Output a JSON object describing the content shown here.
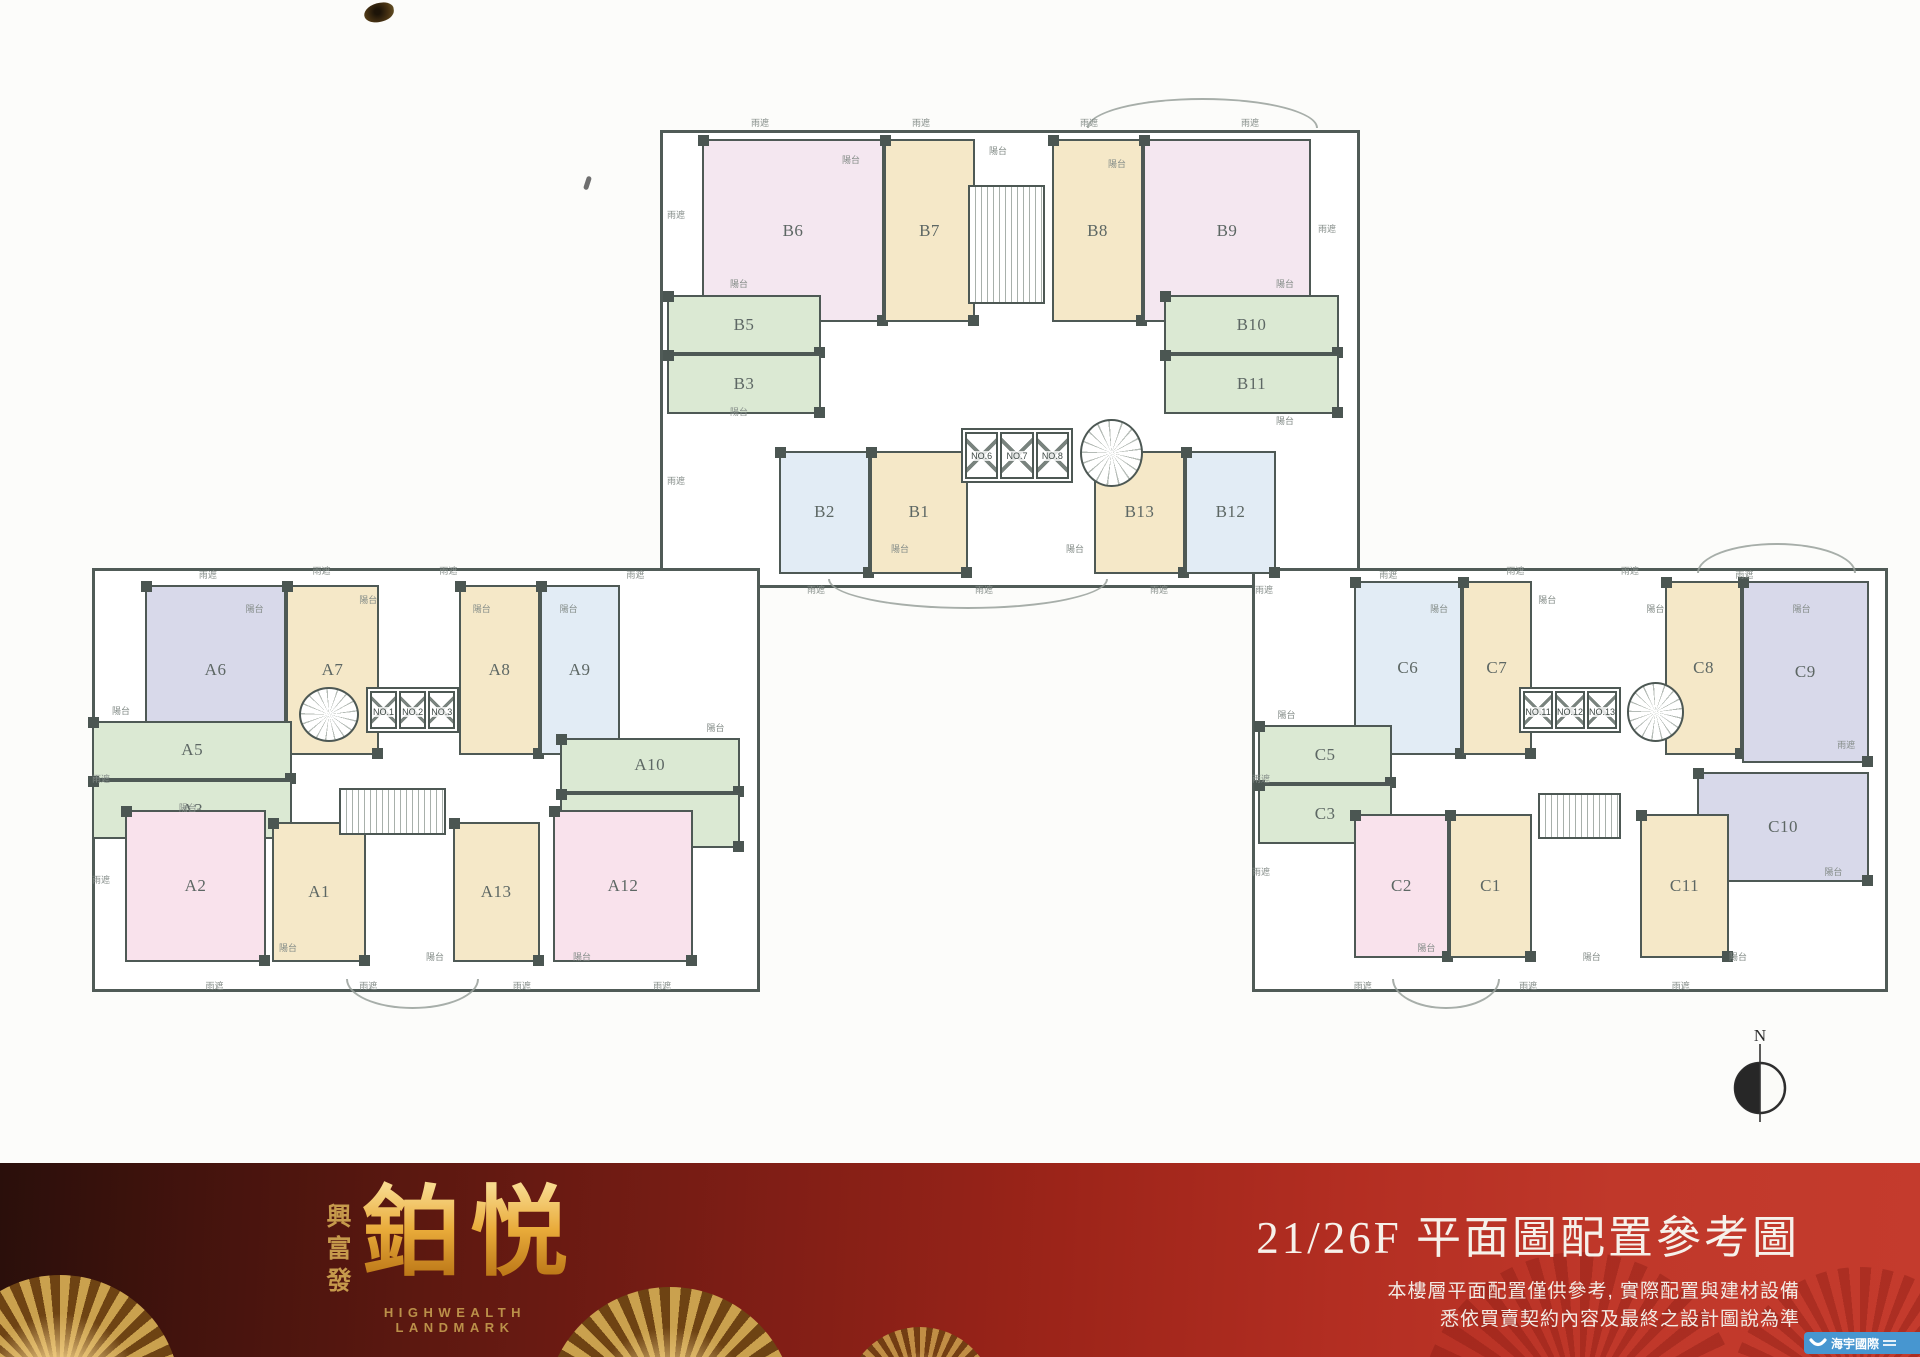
{
  "compass": {
    "label": "N"
  },
  "palette": {
    "green": "#dbe9d3",
    "tan": "#f5e8c8",
    "pink": "#f9e2ec",
    "palepink": "#f4e7f0",
    "blue": "#e2ecf5",
    "lavender": "#d8d9ea"
  },
  "buildings": [
    {
      "id": "building-b",
      "frame": [
        660,
        130,
        700,
        458
      ],
      "units": [
        [
          "B6",
          "palepink",
          6,
          2,
          26,
          40
        ],
        [
          "B7",
          "tan",
          32,
          2,
          13,
          40
        ],
        [
          "B8",
          "tan",
          56,
          2,
          13,
          40
        ],
        [
          "B9",
          "palepink",
          69,
          2,
          24,
          40
        ],
        [
          "B5",
          "green",
          1,
          36,
          22,
          13
        ],
        [
          "B3",
          "green",
          1,
          49,
          22,
          13
        ],
        [
          "B10",
          "green",
          72,
          36,
          25,
          13
        ],
        [
          "B11",
          "green",
          72,
          49,
          25,
          13
        ],
        [
          "B2",
          "blue",
          17,
          70,
          13,
          27
        ],
        [
          "B1",
          "tan",
          30,
          70,
          14,
          27
        ],
        [
          "B13",
          "tan",
          62,
          70,
          13,
          27
        ],
        [
          "B12",
          "blue",
          75,
          70,
          13,
          27
        ]
      ],
      "lifts": {
        "labels": [
          "NO.6",
          "NO.7",
          "NO.8"
        ],
        "box": [
          43,
          65,
          16,
          12
        ]
      },
      "stairRect": [
        44,
        12,
        11,
        26
      ],
      "stairRound": [
        60,
        63,
        9,
        15
      ],
      "arcs": [
        [
          61,
          -7,
          33,
          "top"
        ],
        [
          24,
          98,
          40,
          "bottom"
        ]
      ],
      "annotations": [
        [
          "雨遮",
          13,
          -3
        ],
        [
          "雨遮",
          36,
          -3
        ],
        [
          "陽台",
          26,
          5
        ],
        [
          "陽台",
          47,
          3
        ],
        [
          "雨遮",
          60,
          -3
        ],
        [
          "陽台",
          64,
          6
        ],
        [
          "雨遮",
          83,
          -3
        ],
        [
          "雨遮",
          1,
          17
        ],
        [
          "陽台",
          10,
          32
        ],
        [
          "陽台",
          10,
          60
        ],
        [
          "雨遮",
          1,
          75
        ],
        [
          "陽台",
          33,
          90
        ],
        [
          "雨遮",
          21,
          99
        ],
        [
          "雨遮",
          45,
          99
        ],
        [
          "陽台",
          58,
          90
        ],
        [
          "雨遮",
          70,
          99
        ],
        [
          "陽台",
          88,
          32
        ],
        [
          "雨遮",
          94,
          20
        ],
        [
          "陽台",
          88,
          62
        ],
        [
          "雨遮",
          85,
          99
        ]
      ]
    },
    {
      "id": "building-a",
      "frame": [
        92,
        568,
        668,
        424
      ],
      "units": [
        [
          "A6",
          "lavender",
          8,
          4,
          21,
          40
        ],
        [
          "A7",
          "tan",
          29,
          4,
          14,
          40
        ],
        [
          "A8",
          "tan",
          55,
          4,
          12,
          40
        ],
        [
          "A9",
          "blue",
          67,
          4,
          12,
          40
        ],
        [
          "A5",
          "green",
          0,
          36,
          30,
          14
        ],
        [
          "A3",
          "green",
          0,
          50,
          30,
          14
        ],
        [
          "A10",
          "green",
          70,
          40,
          27,
          13
        ],
        [
          "A11",
          "green",
          70,
          53,
          27,
          13
        ],
        [
          "A2",
          "pink",
          5,
          57,
          21,
          36
        ],
        [
          "A1",
          "tan",
          27,
          60,
          14,
          33
        ],
        [
          "A13",
          "tan",
          54,
          60,
          13,
          33
        ],
        [
          "A12",
          "pink",
          69,
          57,
          21,
          36
        ]
      ],
      "lifts": {
        "labels": [
          "NO.1",
          "NO.2",
          "NO.3"
        ],
        "box": [
          41,
          28,
          14,
          11
        ]
      },
      "stairRect": [
        37,
        52,
        16,
        11
      ],
      "stairRound": [
        31,
        28,
        9,
        13
      ],
      "arcs": [
        [
          38,
          97,
          20,
          "bottom"
        ]
      ],
      "annotations": [
        [
          "雨遮",
          16,
          0
        ],
        [
          "陽台",
          23,
          8
        ],
        [
          "雨遮",
          33,
          -1
        ],
        [
          "陽台",
          40,
          6
        ],
        [
          "雨遮",
          52,
          -1
        ],
        [
          "陽台",
          57,
          8
        ],
        [
          "陽台",
          70,
          8
        ],
        [
          "雨遮",
          80,
          0
        ],
        [
          "陽台",
          3,
          32
        ],
        [
          "雨遮",
          0,
          48
        ],
        [
          "陽台",
          13,
          55
        ],
        [
          "雨遮",
          0,
          72
        ],
        [
          "陽台",
          28,
          88
        ],
        [
          "雨遮",
          17,
          97
        ],
        [
          "雨遮",
          40,
          97
        ],
        [
          "陽台",
          50,
          90
        ],
        [
          "雨遮",
          63,
          97
        ],
        [
          "陽台",
          72,
          90
        ],
        [
          "雨遮",
          84,
          97
        ],
        [
          "陽台",
          92,
          36
        ]
      ]
    },
    {
      "id": "building-c",
      "frame": [
        1252,
        568,
        636,
        424
      ],
      "units": [
        [
          "C6",
          "blue",
          16,
          3,
          17,
          41
        ],
        [
          "C7",
          "tan",
          33,
          3,
          11,
          41
        ],
        [
          "C8",
          "tan",
          65,
          3,
          12,
          41
        ],
        [
          "C9",
          "lavender",
          77,
          3,
          20,
          43
        ],
        [
          "C5",
          "green",
          1,
          37,
          21,
          14
        ],
        [
          "C3",
          "green",
          1,
          51,
          21,
          14
        ],
        [
          "C10",
          "lavender",
          70,
          48,
          27,
          26
        ],
        [
          "C2",
          "pink",
          16,
          58,
          15,
          34
        ],
        [
          "C1",
          "tan",
          31,
          58,
          13,
          34
        ],
        [
          "C11",
          "tan",
          61,
          58,
          14,
          34
        ]
      ],
      "lifts": {
        "labels": [
          "NO.11",
          "NO.12",
          "NO.13"
        ],
        "box": [
          42,
          28,
          16,
          11
        ]
      },
      "stairRect": [
        45,
        53,
        13,
        11
      ],
      "stairRound": [
        59,
        27,
        9,
        14
      ],
      "arcs": [
        [
          70,
          -6,
          25,
          "top"
        ],
        [
          22,
          97,
          17,
          "bottom"
        ]
      ],
      "annotations": [
        [
          "雨遮",
          20,
          0
        ],
        [
          "陽台",
          28,
          8
        ],
        [
          "雨遮",
          40,
          -1
        ],
        [
          "陽台",
          45,
          6
        ],
        [
          "雨遮",
          58,
          -1
        ],
        [
          "陽台",
          62,
          8
        ],
        [
          "雨遮",
          76,
          0
        ],
        [
          "陽台",
          85,
          8
        ],
        [
          "陽台",
          4,
          33
        ],
        [
          "雨遮",
          0,
          48
        ],
        [
          "雨遮",
          0,
          70
        ],
        [
          "陽台",
          26,
          88
        ],
        [
          "雨遮",
          16,
          97
        ],
        [
          "雨遮",
          42,
          97
        ],
        [
          "陽台",
          52,
          90
        ],
        [
          "雨遮",
          66,
          97
        ],
        [
          "陽台",
          75,
          90
        ],
        [
          "雨遮",
          92,
          40
        ],
        [
          "陽台",
          90,
          70
        ]
      ]
    }
  ],
  "footer": {
    "brand_vertical": "興富發",
    "brand_main": "鉑悦",
    "brand_sub": "HIGHWEALTH LANDMARK",
    "title": "21/26F 平面圖配置參考圖",
    "disclaimer_line1": "本樓層平面配置僅供參考, 實際配置與建材設備",
    "disclaimer_line2": "悉依買賣契約內容及最終之設計圖說為準",
    "watermark": "海宇國際"
  }
}
